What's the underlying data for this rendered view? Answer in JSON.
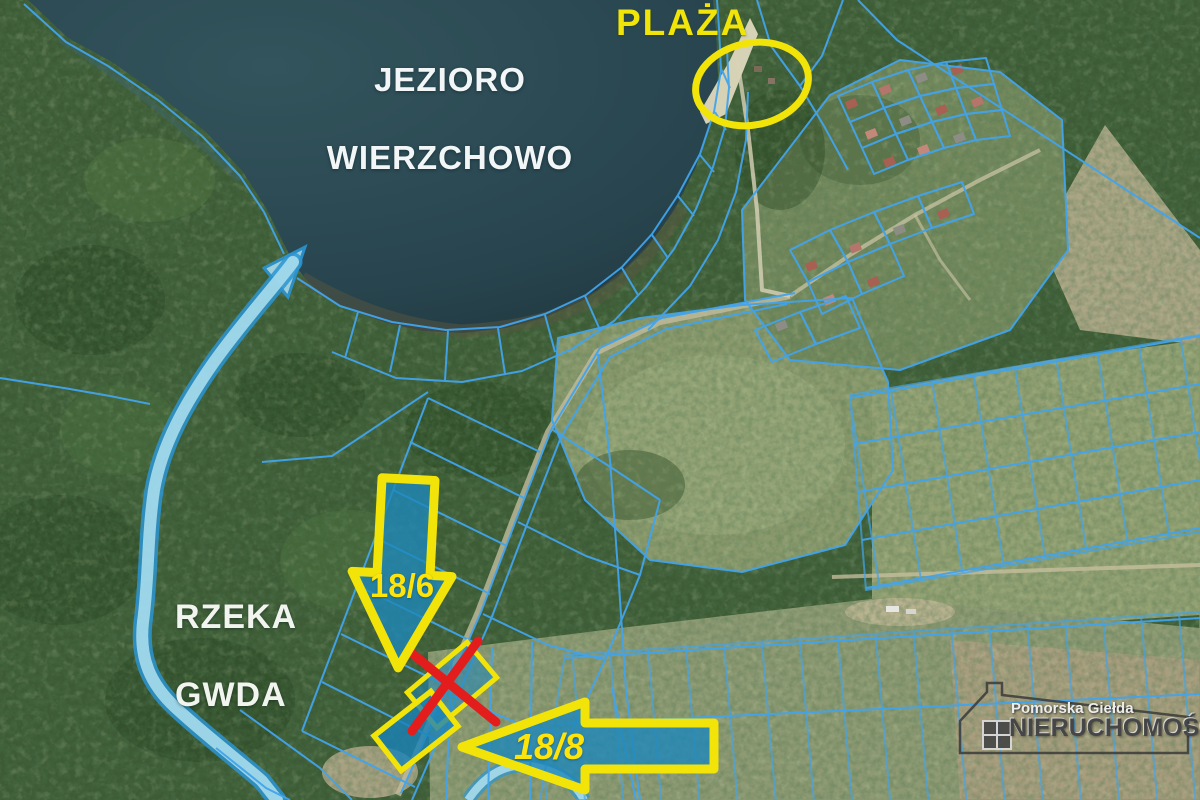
{
  "map": {
    "labels": {
      "lake_line1": "JEZIORO",
      "lake_line2": "WIERZCHOWO",
      "beach": "PLAŻA",
      "river_line1": "RZEKA",
      "river_line2": "GWDA"
    },
    "annotations": {
      "plot_down_arrow_label": "18/6",
      "plot_left_arrow_label": "18/8",
      "beach_marker": "yellow-ellipse",
      "sold_parcel_marker": "red-x"
    },
    "watermark": {
      "line1": "Pomorska Giełda",
      "line2": "NIERUCHOMOŚCI"
    },
    "colors": {
      "parcel_line_blue": "#42a4ec",
      "highlight_yellow": "#f2e409",
      "annotation_red": "#e31c1c",
      "arrow_fill_blue": "#1f8dbf",
      "river_highlight": "#a9dcec",
      "lake_water": "#2c4a52",
      "forest_green": "#3d5c36"
    }
  }
}
